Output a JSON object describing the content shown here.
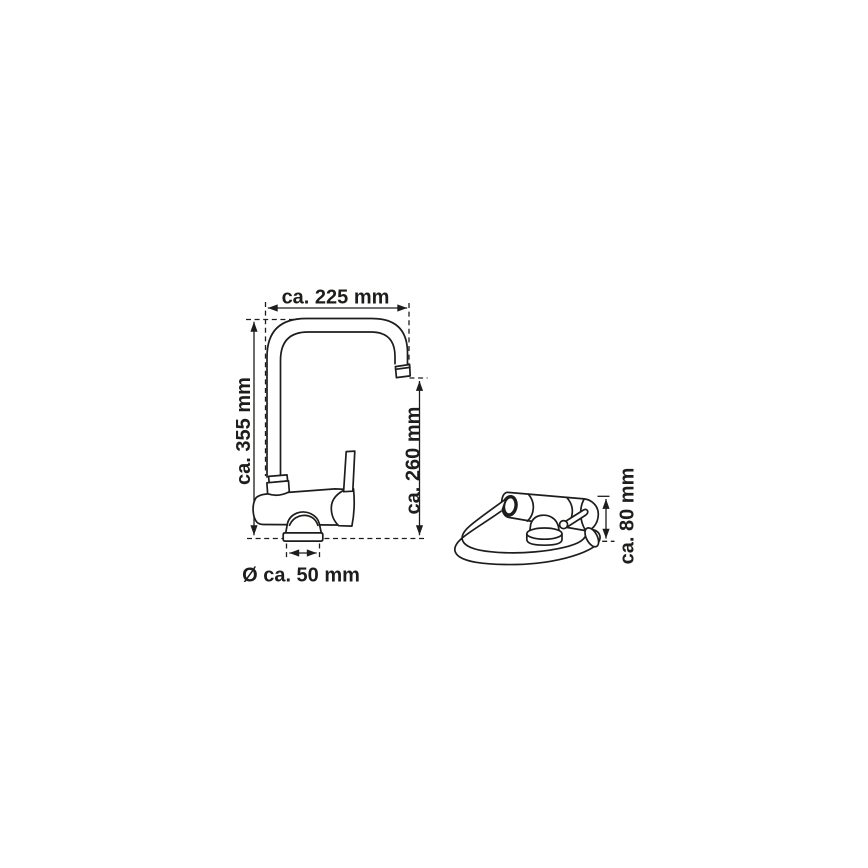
{
  "colors": {
    "background": "#ffffff",
    "line": "#1d1d1b"
  },
  "drawing": {
    "kind": "faucet-technical-dimension-drawing",
    "views": {
      "side": {
        "description_name": "side-view"
      },
      "folded": {
        "description_name": "folded-view"
      }
    }
  },
  "dimensions": {
    "spout_reach": {
      "label": "ca. 225 mm",
      "value_mm": 225,
      "orientation": "horizontal"
    },
    "total_height": {
      "label": "ca. 355 mm",
      "value_mm": 355,
      "orientation": "vertical"
    },
    "outlet_height": {
      "label": "ca. 260 mm",
      "value_mm": 260,
      "orientation": "vertical"
    },
    "base_diameter": {
      "label": "Ø ca. 50 mm",
      "value_mm": 50,
      "orientation": "horizontal"
    },
    "folded_height": {
      "label": "ca. 80 mm",
      "value_mm": 80,
      "orientation": "vertical"
    }
  }
}
